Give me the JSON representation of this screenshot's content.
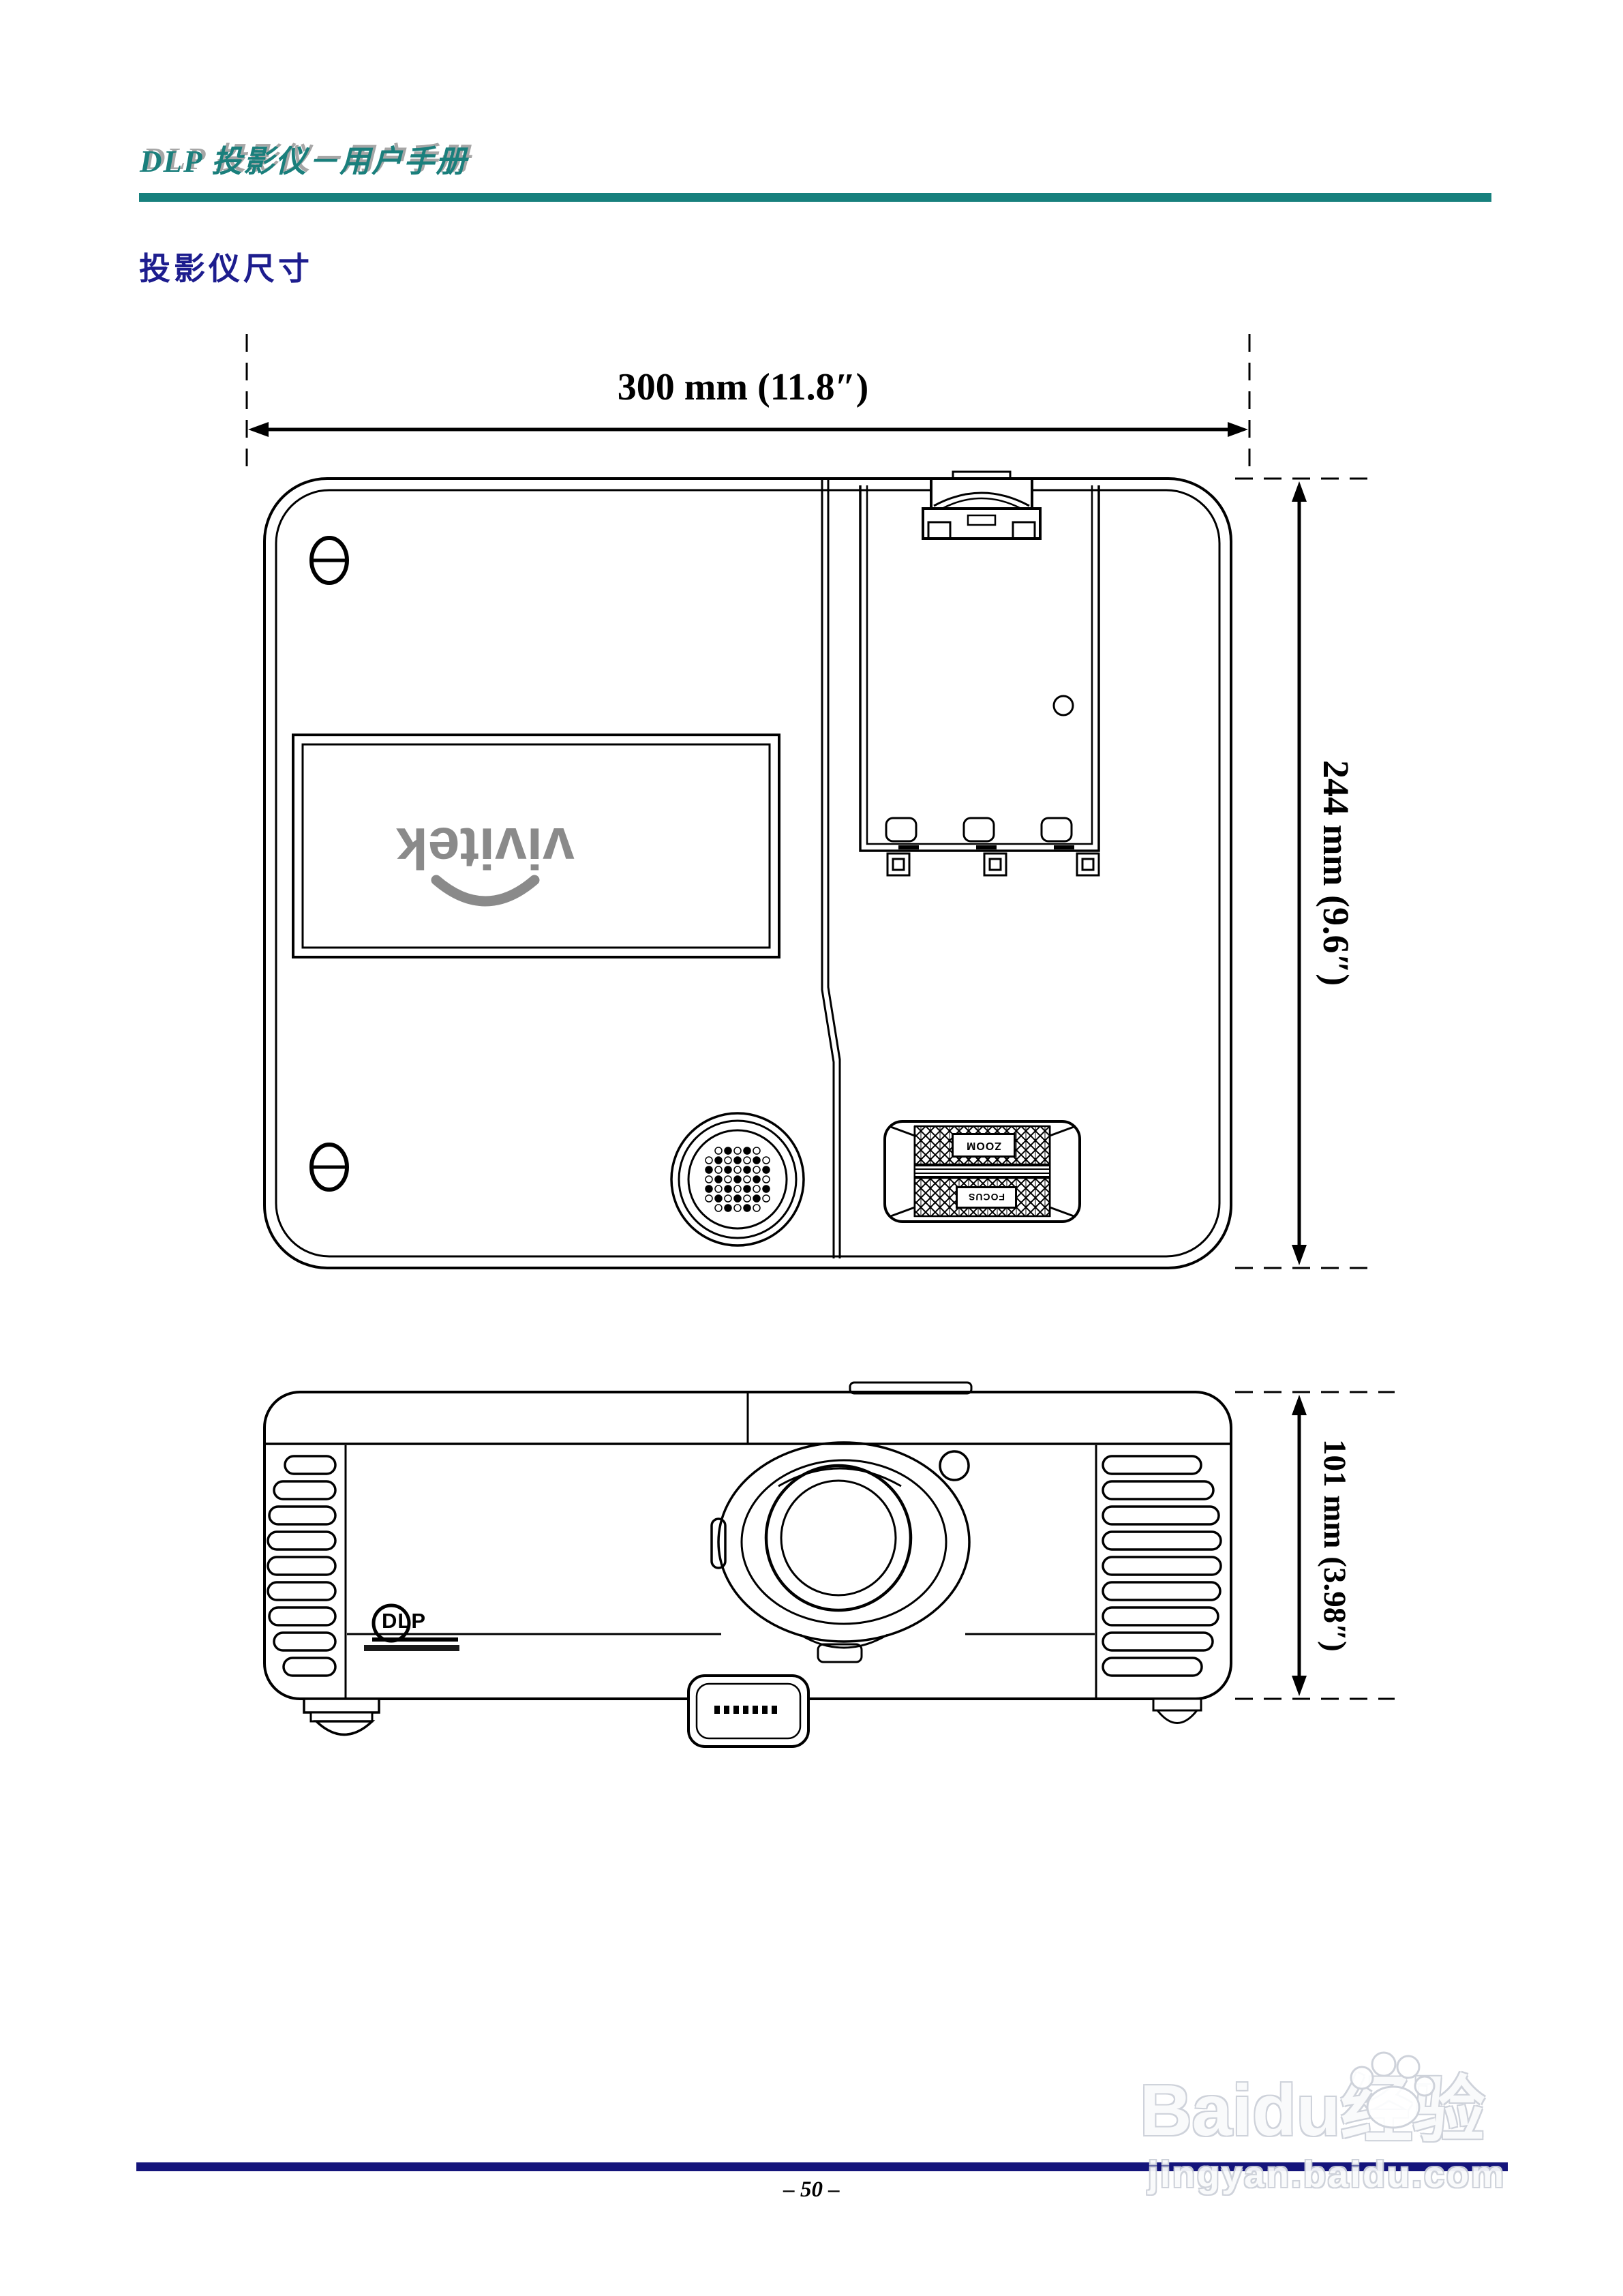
{
  "header": {
    "manual_title": "DLP 投影仪－用户手册"
  },
  "page": {
    "section_title": "投影仪尺寸",
    "page_number": "– 50 –"
  },
  "top_view": {
    "width_label": "300 mm (11.8″)",
    "depth_label": "244 mm (9.6″)",
    "brand_logo": "vivitek",
    "zoom_label": "ZOOM",
    "focus_label": "FOCUS"
  },
  "front_view": {
    "height_label": "101 mm (3.98″)",
    "dlp_label": "DLP"
  },
  "watermark": {
    "brand": "Baidu",
    "suffix": "经验",
    "domain": "jingyan.baidu.com"
  },
  "colors": {
    "header_teal": "#17807d",
    "title_navy": "#1d1d8e",
    "footer_navy": "#14147b",
    "logo_gray": "#8a8a8a",
    "line_black": "#000000",
    "watermark_outline": "#ccd0d9"
  }
}
